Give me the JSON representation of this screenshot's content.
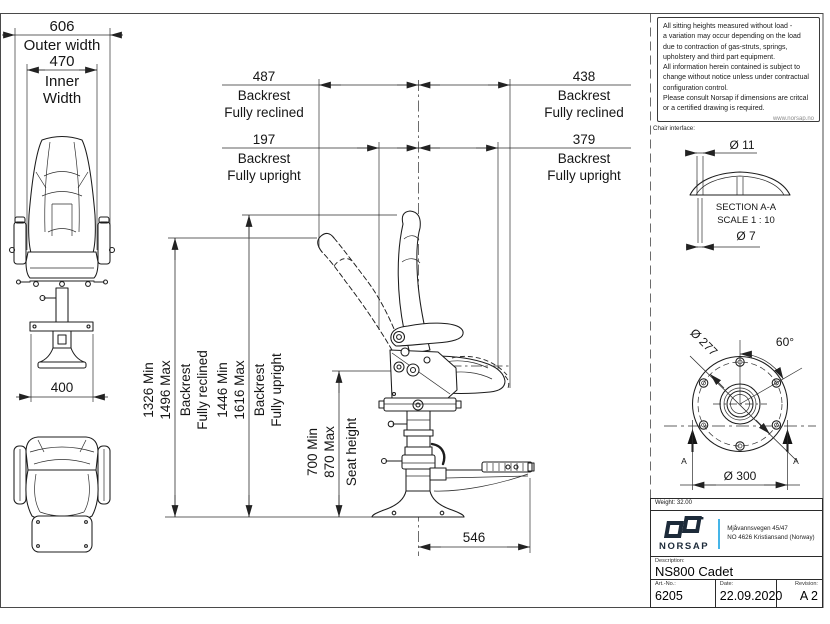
{
  "notes": {
    "lines": [
      "All sitting heights measured without load -",
      "a variation may occur depending on the load",
      "due to contraction of gas-struts, springs,",
      "upholstery and third part equipment.",
      "All information herein contained is subject to",
      "change without notice unless under contractual",
      "configuration control.",
      "Please consult Norsap if dimensions are critcal",
      "or a certified drawing is required."
    ],
    "website": "www.norsap.no"
  },
  "chair_interface_label": "Chair interface:",
  "section_aa": {
    "dia_top": "Ø 11",
    "title": "SECTION A-A",
    "scale": "SCALE 1 : 10",
    "dia_bottom": "Ø 7"
  },
  "flange": {
    "bolt_circle_dia": "Ø 277",
    "hole_angle": "60°",
    "outer_dia": "Ø 300",
    "section_marker": "A"
  },
  "dims": {
    "outer_width_value": "606",
    "outer_width_label": "Outer width",
    "inner_width_value": "470",
    "inner_width_label_1": "Inner",
    "inner_width_label_2": "Width",
    "base_width_value": "400",
    "footrest_depth_value": "546",
    "reclined_rear_value": "487",
    "reclined_front_value": "438",
    "reclined_label_1": "Backrest",
    "reclined_label_2": "Fully reclined",
    "upright_rear_value": "197",
    "upright_front_value": "379",
    "upright_label_1": "Backrest",
    "upright_label_2": "Fully upright",
    "height_reclined_min": "1326 Min",
    "height_reclined_max": "1496 Max",
    "height_reclined_label_1": "Backrest",
    "height_reclined_label_2": "Fully reclined",
    "height_upright_min": "1446 Min",
    "height_upright_max": "1616 Max",
    "height_upright_label_1": "Backrest",
    "height_upright_label_2": "Fully upright",
    "seat_height_min": "700 Min",
    "seat_height_max": "870 Max",
    "seat_height_label": "Seat height"
  },
  "title_block": {
    "weight": "Weight: 32.00",
    "brand": "NORSAP",
    "address_line_1": "Mjåvannsvegen 45/47",
    "address_line_2": "NO 4626  Kristiansand (Norway)",
    "description_label": "Description:",
    "description": "NS800 Cadet",
    "art_no_label": "Art.-No.:",
    "art_no": "6205",
    "date_label": "Date:",
    "date": "22.09.2020",
    "revision_label": "Revision:",
    "revision": "A 2"
  }
}
